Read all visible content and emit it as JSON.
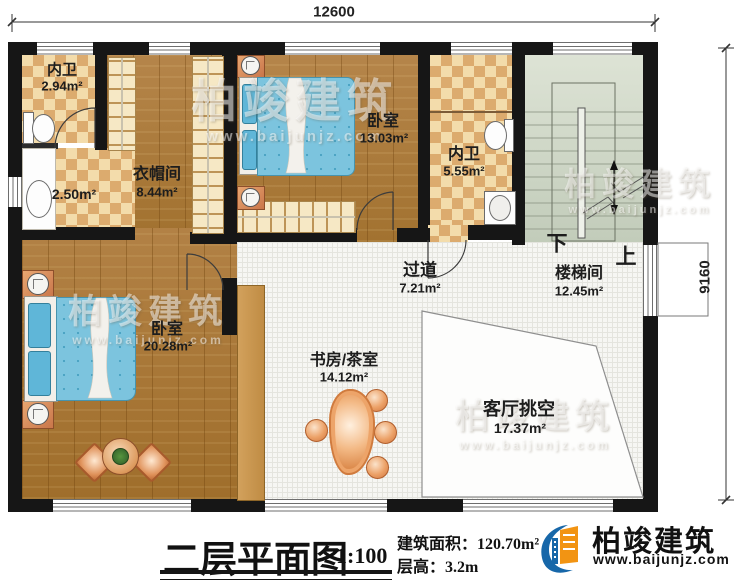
{
  "dimensions": {
    "width_mm": "12600",
    "depth_mm": "9160"
  },
  "rooms": {
    "bath1": {
      "label": "内卫",
      "area": "2.94m²"
    },
    "wash": {
      "area": "2.50m²"
    },
    "cloakroom": {
      "label": "衣帽间",
      "area": "8.44m²"
    },
    "bedroom1": {
      "label": "卧室",
      "area": "13.03m²"
    },
    "bath2": {
      "label": "内卫",
      "area": "5.55m²"
    },
    "stairwell": {
      "label": "楼梯间",
      "area": "12.45m²",
      "down": "下",
      "up": "上"
    },
    "corridor": {
      "label": "过道",
      "area": "7.21m²"
    },
    "bedroom2": {
      "label": "卧室",
      "area": "20.28m²"
    },
    "study": {
      "label": "书房/茶室",
      "area": "14.12m²"
    },
    "void": {
      "label": "客厅挑空",
      "area": "17.37m²"
    }
  },
  "title_block": {
    "title": "二层平面图",
    "scale": "1:100",
    "building_area": "建筑面积：120.70m²",
    "floor_height": "层高：3.2m"
  },
  "brand": {
    "name": "柏竣建筑",
    "url": "www.baijunjz.com"
  },
  "colors": {
    "wall": "#161616",
    "logo_blue": "#1767a9",
    "logo_orange": "#f29413",
    "bed_blue": "#7cc4de",
    "stair_floor": "#ced7c6",
    "tile_beige": "#f0d7a6",
    "wood": "#ab7a35"
  }
}
